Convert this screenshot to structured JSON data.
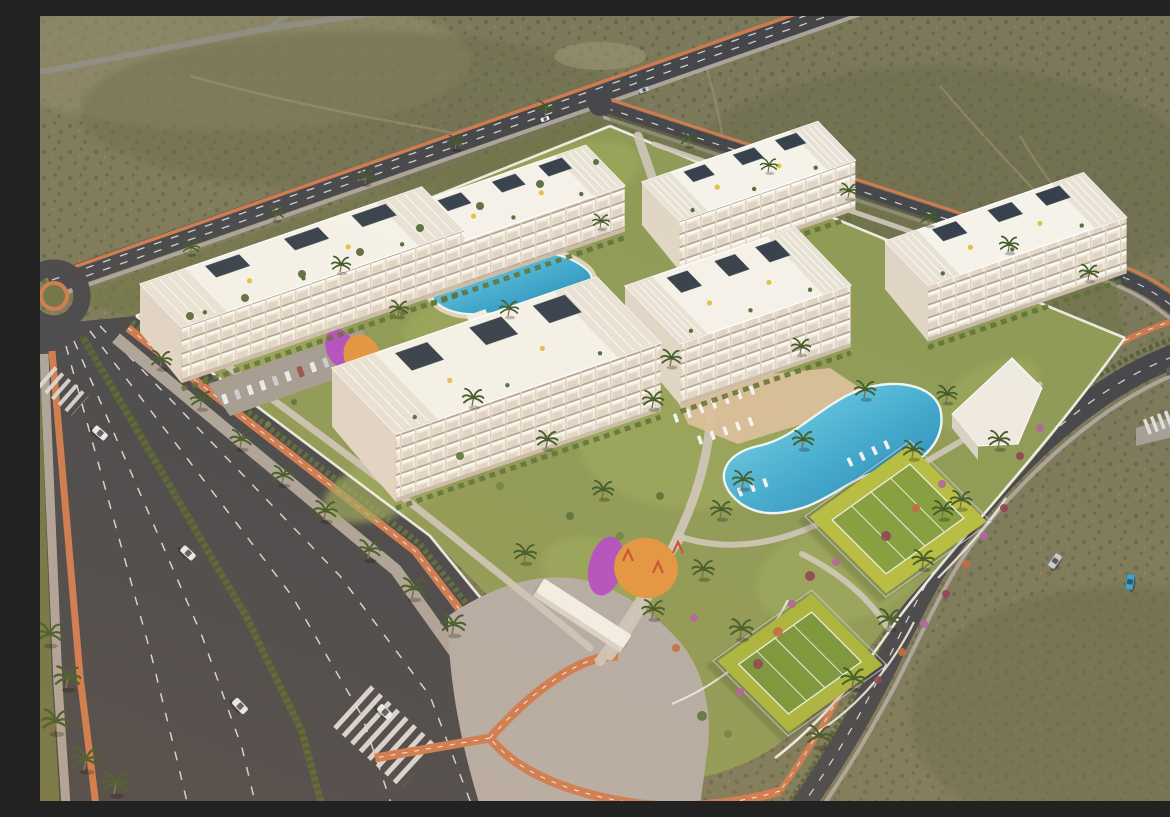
{
  "meta": {
    "description": "Aerial oblique 3D architectural rendering at golden hour of a gated residential resort: six white four-storey apartment blocks with balconies, rooftop terraces, pergolas and solar panels arranged around landscaped gardens; a north pool and a central lagoon pool with white sun loungers on sand-coloured decks; two paddle courts; two playgrounds in orange and purple; resident parking rows; a white perimeter wall; palm-lined boulevards with terracotta bike lanes, a roundabout, zebra crossings and passing cars; desert scrubland surrounds the site.",
    "view": "aerial-oblique",
    "time_of_day": "golden hour",
    "text_content": "none"
  },
  "palette": {
    "desert": "#7b795a",
    "scrub_dark": "#5a5c42",
    "scrub_mid": "#6b6b4c",
    "sand_light": "#8f8b6b",
    "trail": "#9a9474",
    "asphalt": "#45464a",
    "lane_line": "#dededd",
    "bike_lane": "#cd7a4e",
    "sidewalk": "#aba39a",
    "plaza": "#b3aca6",
    "verge_green": "#6e7446",
    "median_green": "#566139",
    "hedge": "#4f6031",
    "lawn": "#8d9a55",
    "lawn_light": "#9aa75c",
    "wall_white": "#f2efe8",
    "path_light": "#cdc6ba",
    "deck": "#d9bf9b",
    "pool_light": "#74d2e6",
    "pool_deep": "#1f7fae",
    "pool_rim": "#eef6f8",
    "building_face": "#f1eadd",
    "building_side": "#e0d5c5",
    "roof": "#f5f2ea",
    "roof_pergola": "#e8e2d6",
    "solar": "#36404b",
    "court_pad": "#b5bd41",
    "court_inner": "#839e3c",
    "court_pad2": "#a8b43c",
    "court_inner2": "#789539",
    "fence": "#c6d0da",
    "play_orange": "#e2953f",
    "play_purple": "#b24fc0",
    "play_red": "#c94f35",
    "flower_red": "#8a4152",
    "flower_pink": "#b0639c",
    "flower_orange": "#c06a3e",
    "green_shrub": "#55703a",
    "green_shrub2": "#6b8340",
    "palm_green": "#3f5a28",
    "palm_trunk": "#7a6a4a",
    "car_white": "#e9ebec",
    "car_silver": "#c9ccd0",
    "car_blue": "#2fa3d8",
    "car_dark": "#585e63",
    "car_red": "#9a5248",
    "umbrella_yellow": "#e3c04a",
    "shadow": "#1d2019"
  },
  "scene": {
    "buildings": {
      "count": 6,
      "style": "white 4-storey apartment blocks with balcony grids, rooftop terraces, pergolas and solar panels"
    },
    "pools": [
      {
        "name": "north pool"
      },
      {
        "name": "central lagoon pool"
      }
    ],
    "sports": {
      "paddle_courts": 2
    },
    "playgrounds": 2,
    "parking_cars": 11,
    "road_vehicles": [
      {
        "color": "white"
      },
      {
        "color": "white"
      },
      {
        "color": "white"
      },
      {
        "color": "white"
      },
      {
        "color": "silver"
      },
      {
        "color": "silver"
      },
      {
        "color": "blue"
      },
      {
        "color": "dark-grey"
      }
    ],
    "roads": {
      "boulevard_lanes": 6,
      "bike_lane_color_name": "terracotta",
      "roundabout": 1,
      "zebra_crossings": 3
    }
  },
  "counts": {
    "palms": 51,
    "loungers_rows": 9,
    "loungers_main_pool": 25,
    "loungers_north_pool": 15
  }
}
